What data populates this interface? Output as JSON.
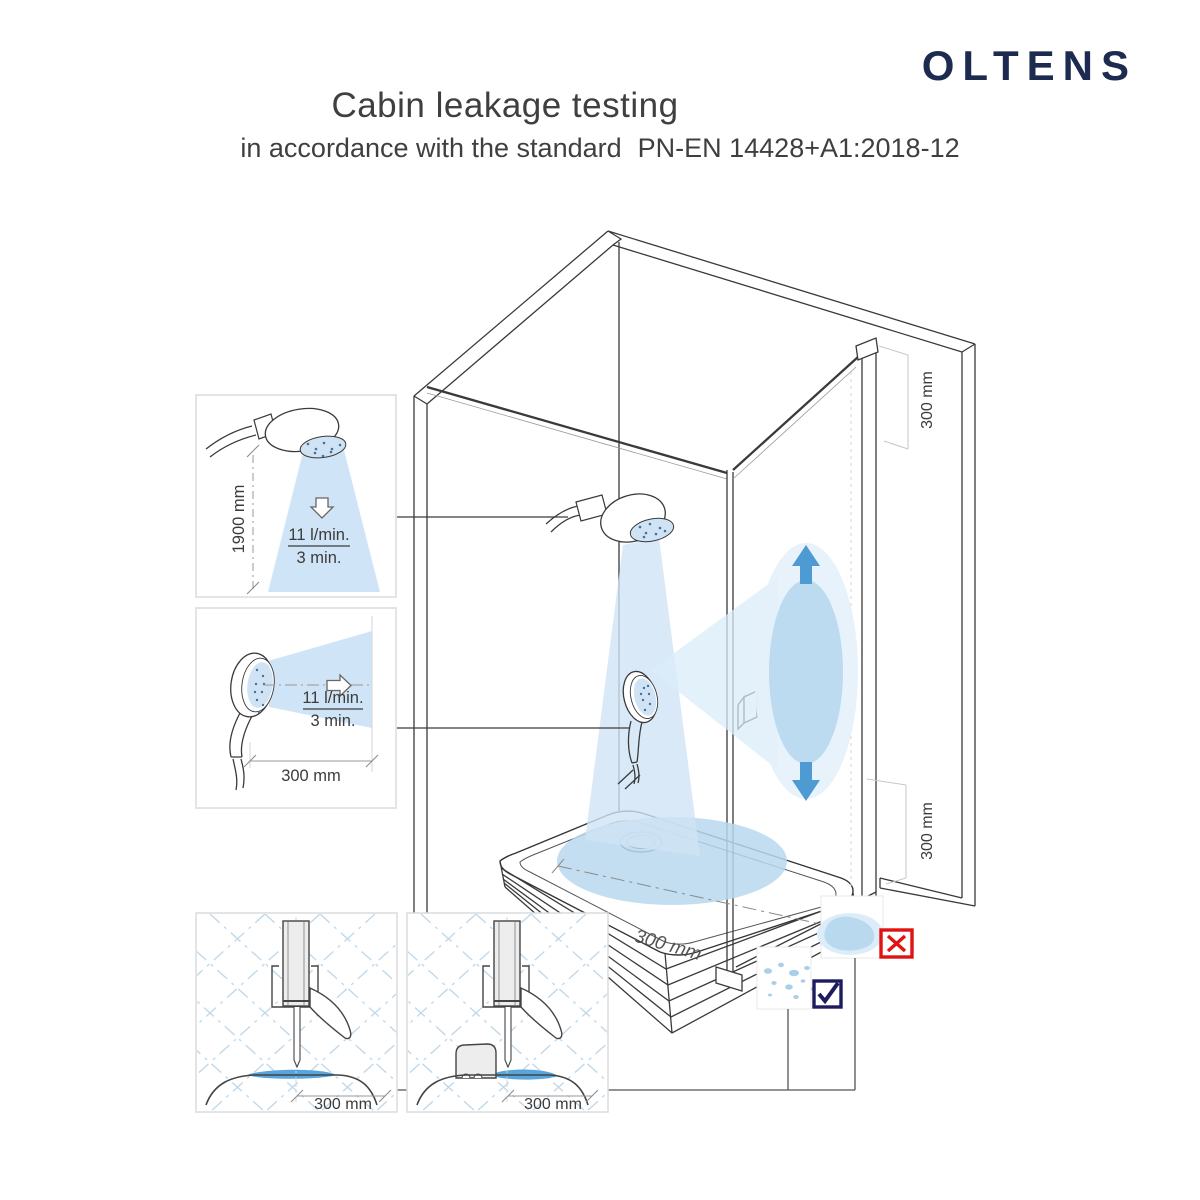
{
  "brand": {
    "logo_text": "OLTENS"
  },
  "header": {
    "title": "Cabin leakage testing",
    "subtitle_prefix": "in accordance with the standard",
    "standard_code": "PN-EN 14428+A1:2018-12"
  },
  "insets": {
    "top_spray": {
      "height_label": "1900 mm",
      "flow_label": "11 l/min.",
      "duration_label": "3 min."
    },
    "side_spray": {
      "distance_label": "300 mm",
      "flow_label": "11 l/min.",
      "duration_label": "3 min."
    },
    "seal_plain": {
      "distance_label": "300 mm"
    },
    "seal_block": {
      "distance_label": "300 mm"
    }
  },
  "cabin": {
    "tray_width_label": "300 mm",
    "top_gap_label": "300 mm",
    "bottom_gap_label": "300 mm"
  },
  "result_marks": {
    "fail": "x-mark",
    "pass": "check-mark"
  },
  "colors": {
    "brand_navy": "#1d2b50",
    "fail_red": "#e01212",
    "pass_navy": "#1c1c5e",
    "spray_light": "#d3e7f6",
    "spray_medium": "#b9d8ef",
    "water_blue": "#57a5dd",
    "arrow_blue": "#4e9bd4"
  }
}
